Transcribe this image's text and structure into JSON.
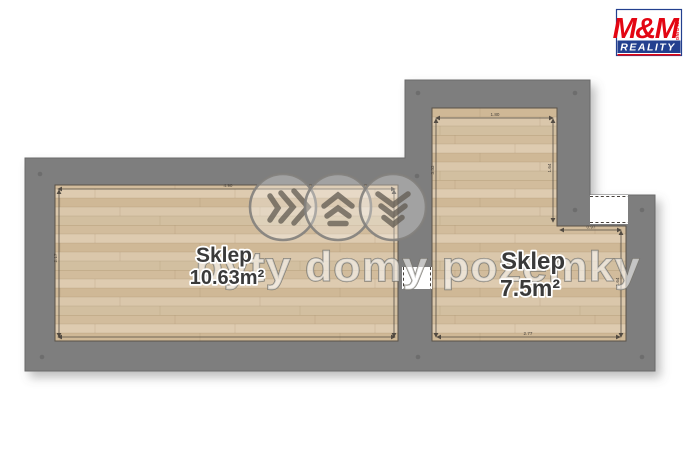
{
  "plan": {
    "rooms": [
      {
        "name": "Sklep",
        "area": "10.63m²"
      },
      {
        "name": "Sklep",
        "area": "7.5m²"
      }
    ],
    "dims": {
      "left_top": "4.90",
      "left_side": "2.17",
      "right_top": "1.80",
      "right_left": "3.33",
      "right_upper": "1.64",
      "right_step": "0.97",
      "right_lower": "1.64",
      "right_bottom": "2.77"
    }
  },
  "watermark": {
    "text": "byty domy pozemky"
  },
  "logo": {
    "title": "M&M",
    "subtitle": "REALITY",
    "vertical": "HOLDING"
  },
  "colors": {
    "wall": "#7e7e7e",
    "floor": "#d8c5a8",
    "logo_red": "#e30613",
    "logo_blue": "#23408f"
  }
}
